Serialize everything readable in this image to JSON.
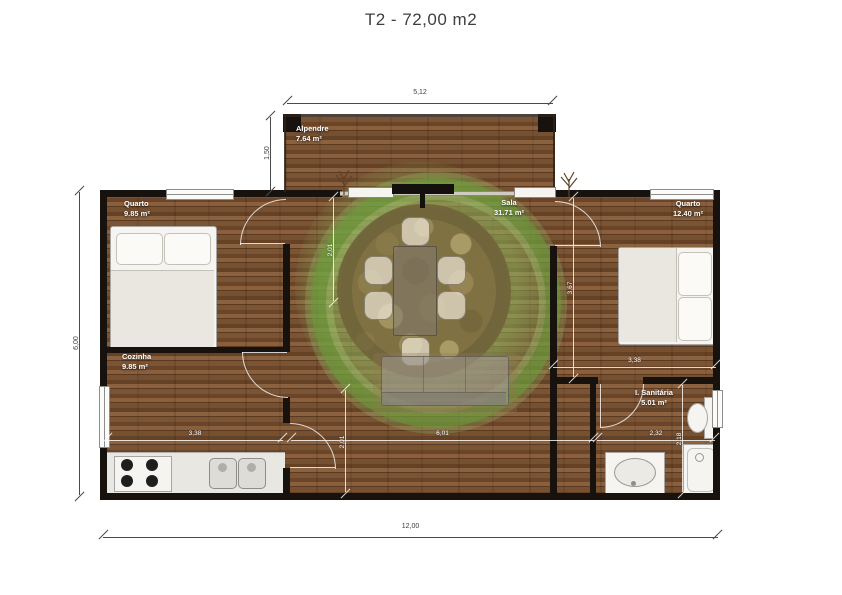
{
  "title": "T2 - 72,00 m2",
  "rooms": {
    "quarto1": {
      "name": "Quarto",
      "area": "9.85 m²"
    },
    "alpendre": {
      "name": "Alpendre",
      "area": "7.64 m²"
    },
    "sala": {
      "name": "Sala",
      "area": "31.71 m²"
    },
    "quarto2": {
      "name": "Quarto",
      "area": "12.40 m²"
    },
    "cozinha": {
      "name": "Cozinha",
      "area": "9.85 m²"
    },
    "sanitaria": {
      "name": "I. Sanitária",
      "area": "5.01 m²"
    }
  },
  "dimensions": {
    "porch_width": "5,12",
    "porch_depth": "1,50",
    "total_depth": "6,00",
    "total_width": "12,00",
    "sala_top_offset": "2,01",
    "bedroom2_depth": "3,67",
    "bedroom2_width": "3,38",
    "kitchen_width": "3,38",
    "sala_width": "6,01",
    "bathroom_width": "2,32",
    "bathroom_depth": "2,18",
    "sala_bottom_offset": "2,01"
  },
  "colors": {
    "wall": "#17120e",
    "wood_dark": "#5c3a22",
    "wood_light": "#8a6240",
    "accent_green": "#689c38",
    "fixture_white": "#f5f4f0"
  }
}
